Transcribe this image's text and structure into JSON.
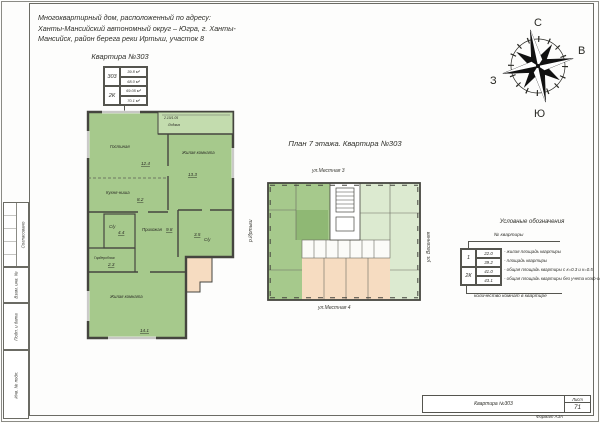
{
  "sheet": {
    "address_line1": "Многоквартирный  дом, расположенный по адресу:",
    "address_line2": "Ханты-Мансийский автономный округ – Югра, г. Ханты-",
    "address_line3": "Мансийск, район берега реки Иртыш, участок 8",
    "subtitle": "Квартира №303"
  },
  "apartment_stamp": {
    "number": "303",
    "rooms": "2К",
    "living_area": "39.8 м²",
    "apartment_area": "68.0 м²",
    "total_area_coef": "69.05 м²",
    "total_area_full": "70.1 м²"
  },
  "main_plan": {
    "rooms": [
      {
        "name": "Гостиная",
        "area": "12.4"
      },
      {
        "name": "Кухня-ниша",
        "area": "8.2"
      },
      {
        "name": "Лоджия",
        "area": "2.10/1.05"
      },
      {
        "name": "Жилая комната",
        "area": "13.3"
      },
      {
        "name": "С/у",
        "area": "3.5"
      },
      {
        "name": "С/у",
        "area": "4.4"
      },
      {
        "name": "Прихожая",
        "area": "9.8"
      },
      {
        "name": "Гардеробная",
        "area": "2.3"
      },
      {
        "name": "Жилая комната",
        "area": "14.1"
      }
    ]
  },
  "floor_plan": {
    "title": "План 7 этажа. Квартира №303",
    "street_top": "ул.Местная 3",
    "street_bottom": "ул.Местная 4",
    "street_right": "ул. Весенняя",
    "street_left": "р.Иртыш"
  },
  "legend": {
    "title": "Условные обозначения",
    "pointer_top": "№ квартиры",
    "pointer_bottom": "количество комнат в квартире",
    "number": "1",
    "rooms": "2К",
    "rows": [
      {
        "value": "22.0",
        "label": "- жилая площадь квартиры"
      },
      {
        "value": "39.2",
        "label": "- площадь квартиры"
      },
      {
        "value": "41.0",
        "label": "- общая площадь квартиры с к=0.3 и к=0.5"
      },
      {
        "value": "43.1",
        "label": "- общая площадь квартиры без учета коэф-ов"
      }
    ]
  },
  "compass": {
    "north": "С",
    "east": "В",
    "south": "Ю",
    "west": "З"
  },
  "title_block": {
    "name": "Квартира №303",
    "sheet_label": "Лист",
    "sheet_number": "71",
    "format": "Формат А3А"
  },
  "frame_labels": {
    "approved": "Согласовано",
    "vzam": "Взам. инв. №",
    "podp": "Подп. и дата",
    "inv": "Инв. № подл."
  },
  "colors": {
    "room_green": "#a6c98c",
    "loggia_green": "#c3dcae",
    "light_green": "#dcead0",
    "peach": "#f6dcc1",
    "wall": "#45453f"
  }
}
